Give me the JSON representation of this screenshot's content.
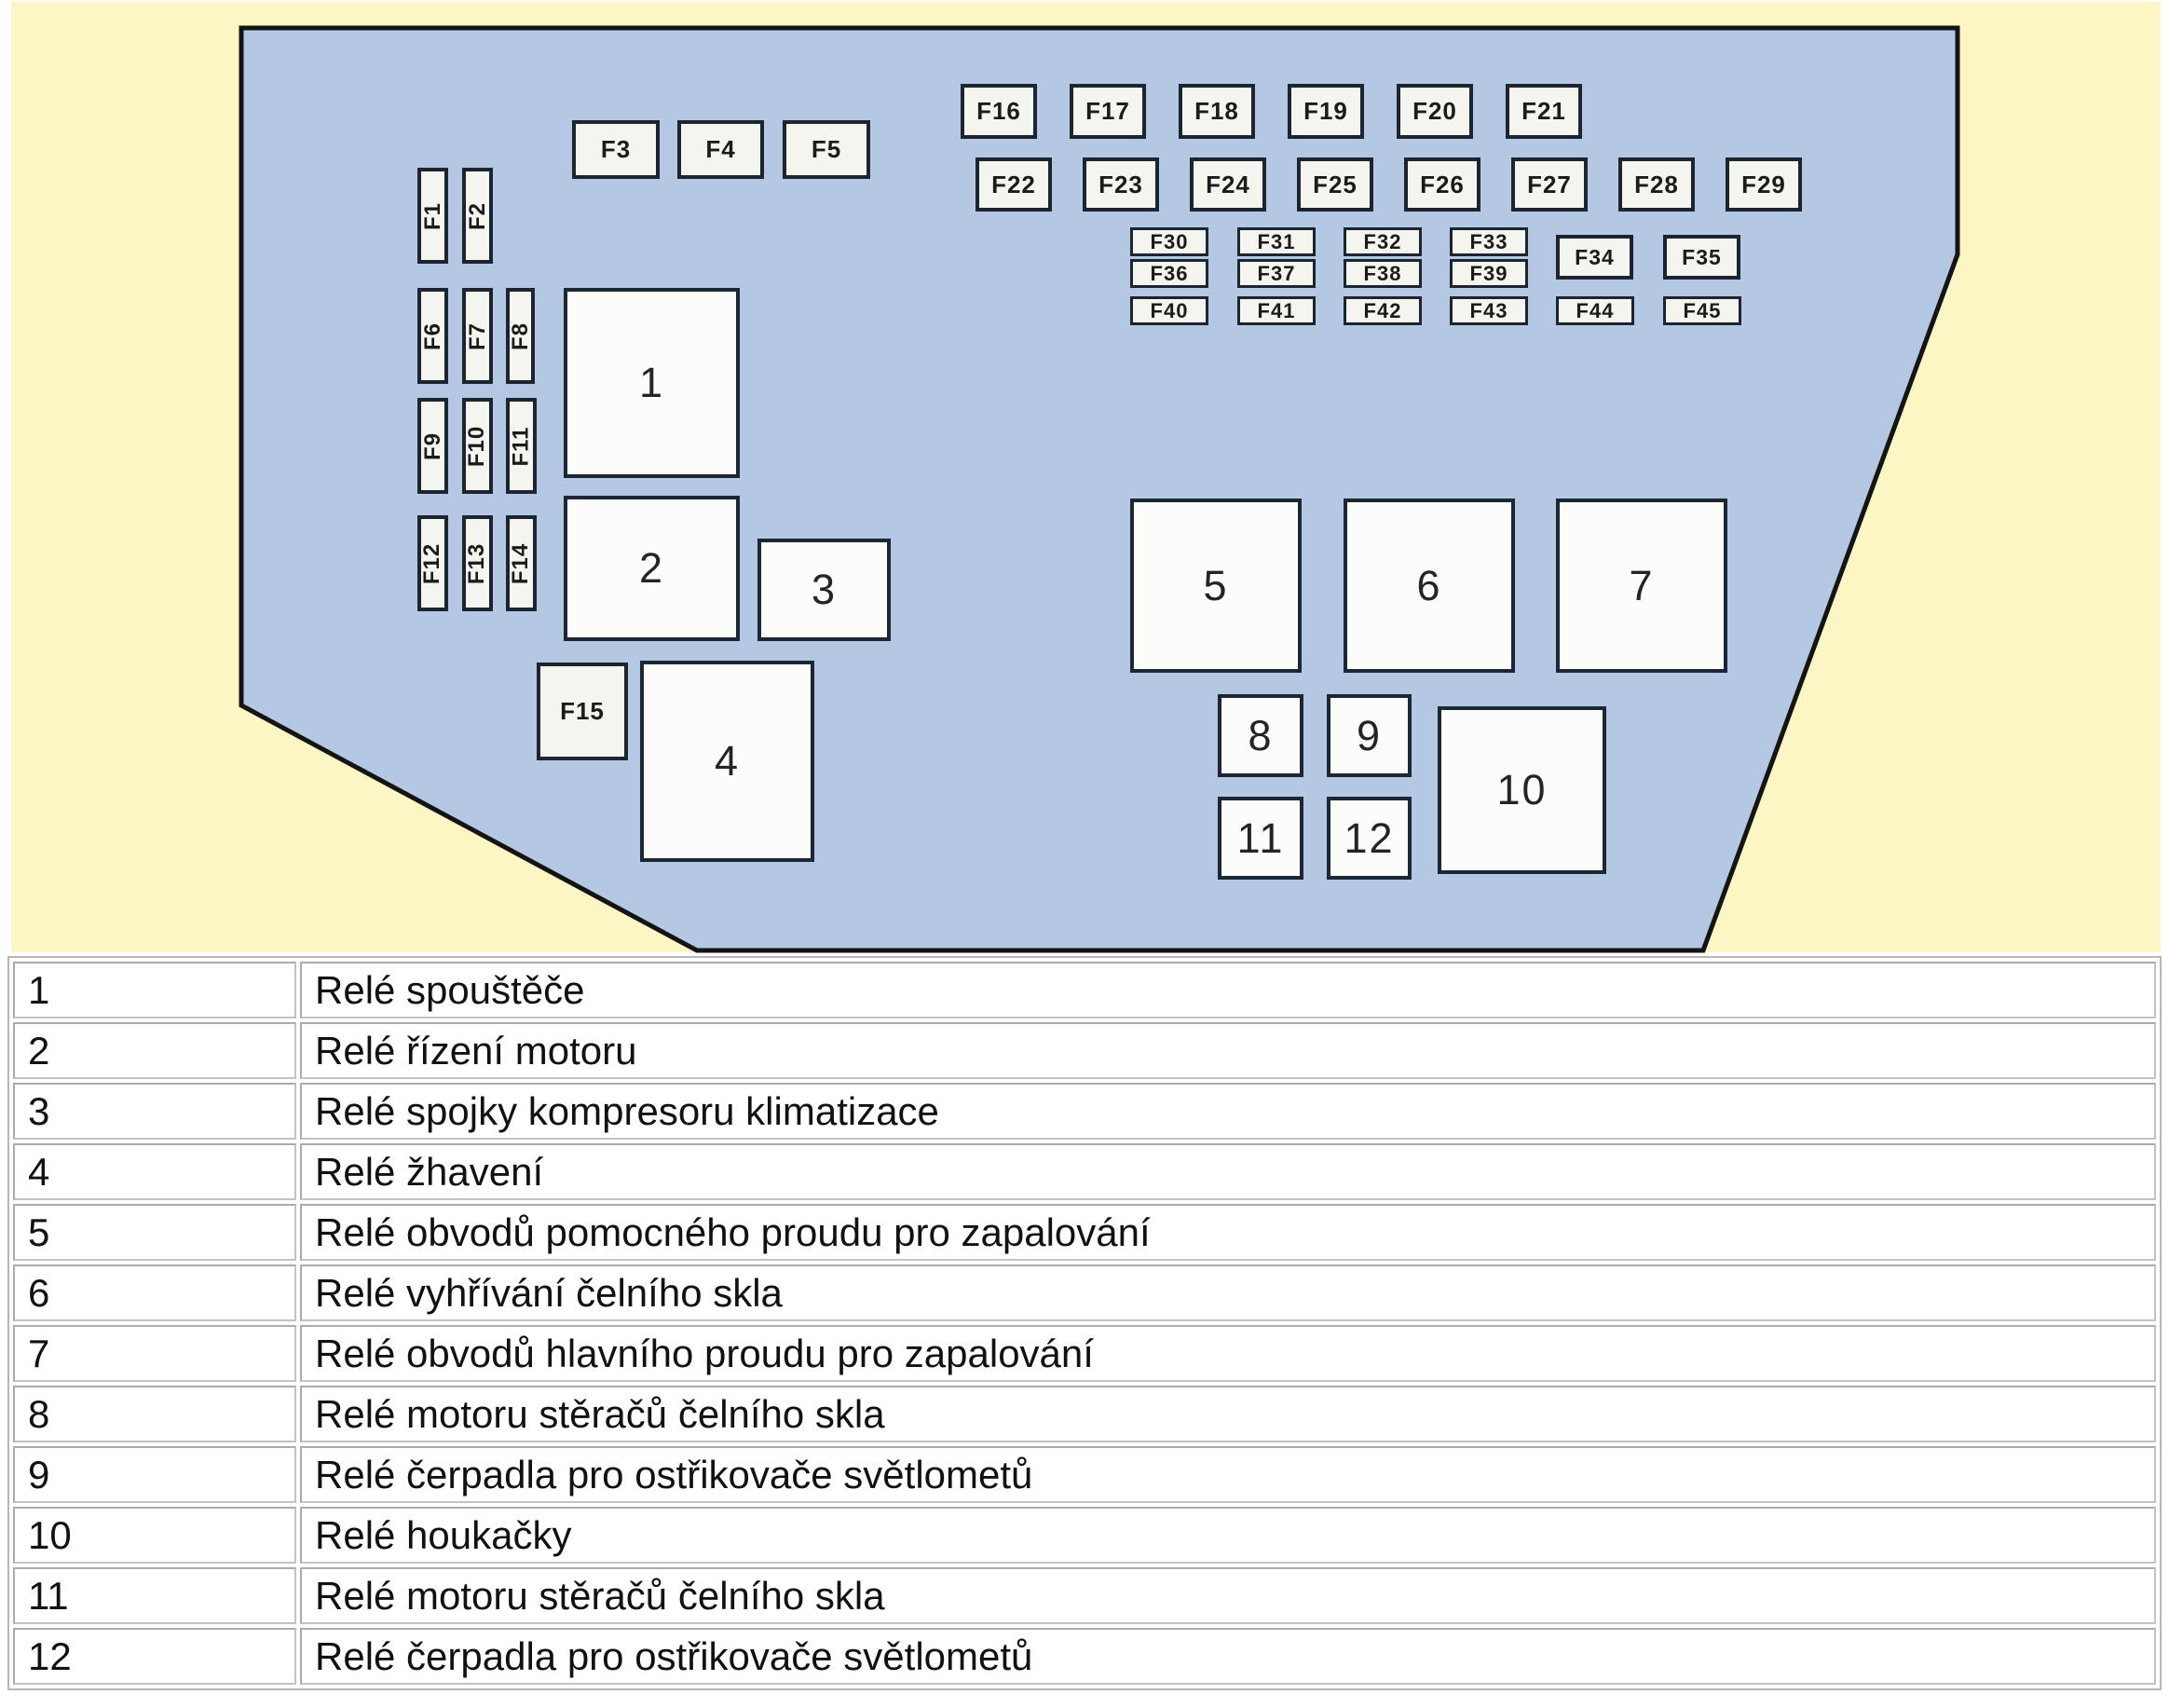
{
  "colors": {
    "page_background": "#ffffff",
    "diagram_background": "#fbf6c3",
    "panel_fill": "#b5c8e3",
    "panel_outline": "#141414",
    "box_fill": "#f5f5f0",
    "box_outline": "#1c2430",
    "table_border": "#c3c3c3",
    "text": "#111111"
  },
  "diagram": {
    "fuses": [
      {
        "label": "F1"
      },
      {
        "label": "F2"
      },
      {
        "label": "F3"
      },
      {
        "label": "F4"
      },
      {
        "label": "F5"
      },
      {
        "label": "F6"
      },
      {
        "label": "F7"
      },
      {
        "label": "F8"
      },
      {
        "label": "F9"
      },
      {
        "label": "F10"
      },
      {
        "label": "F11"
      },
      {
        "label": "F12"
      },
      {
        "label": "F13"
      },
      {
        "label": "F14"
      },
      {
        "label": "F15"
      },
      {
        "label": "F16"
      },
      {
        "label": "F17"
      },
      {
        "label": "F18"
      },
      {
        "label": "F19"
      },
      {
        "label": "F20"
      },
      {
        "label": "F21"
      },
      {
        "label": "F22"
      },
      {
        "label": "F23"
      },
      {
        "label": "F24"
      },
      {
        "label": "F25"
      },
      {
        "label": "F26"
      },
      {
        "label": "F27"
      },
      {
        "label": "F28"
      },
      {
        "label": "F29"
      },
      {
        "label": "F30"
      },
      {
        "label": "F31"
      },
      {
        "label": "F32"
      },
      {
        "label": "F33"
      },
      {
        "label": "F34"
      },
      {
        "label": "F35"
      },
      {
        "label": "F36"
      },
      {
        "label": "F37"
      },
      {
        "label": "F38"
      },
      {
        "label": "F39"
      },
      {
        "label": "F40"
      },
      {
        "label": "F41"
      },
      {
        "label": "F42"
      },
      {
        "label": "F43"
      },
      {
        "label": "F44"
      },
      {
        "label": "F45"
      }
    ],
    "relays": [
      {
        "label": "1"
      },
      {
        "label": "2"
      },
      {
        "label": "3"
      },
      {
        "label": "4"
      },
      {
        "label": "5"
      },
      {
        "label": "6"
      },
      {
        "label": "7"
      },
      {
        "label": "8"
      },
      {
        "label": "9"
      },
      {
        "label": "10"
      },
      {
        "label": "11"
      },
      {
        "label": "12"
      }
    ]
  },
  "legend": {
    "rows": [
      {
        "num": "1",
        "text": "Relé spouštěče"
      },
      {
        "num": "2",
        "text": "Relé řízení motoru"
      },
      {
        "num": "3",
        "text": "Relé spojky kompresoru klimatizace"
      },
      {
        "num": "4",
        "text": "Relé žhavení"
      },
      {
        "num": "5",
        "text": "Relé obvodů pomocného proudu pro zapalování"
      },
      {
        "num": "6",
        "text": "Relé vyhřívání čelního skla"
      },
      {
        "num": "7",
        "text": "Relé obvodů hlavního proudu pro zapalování"
      },
      {
        "num": "8",
        "text": "Relé motoru stěračů čelního skla"
      },
      {
        "num": "9",
        "text": "Relé čerpadla pro ostřikovače světlometů"
      },
      {
        "num": "10",
        "text": "Relé houkačky"
      },
      {
        "num": "11",
        "text": "Relé motoru stěračů čelního skla"
      },
      {
        "num": "12",
        "text": "Relé čerpadla pro ostřikovače světlometů"
      }
    ]
  }
}
